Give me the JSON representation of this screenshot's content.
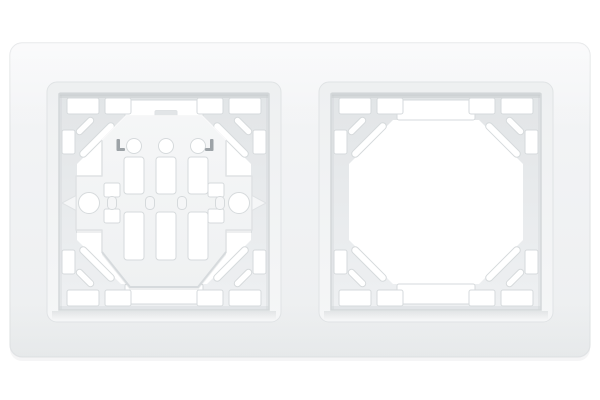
{
  "scene": {
    "type": "product-photo",
    "subject": "White plastic two-gang wall frame for electrical switches and sockets",
    "description": "Horizontal white double frame on a plain white background. The left aperture holds a white octagonal mounting strap with two side fixing screw holes, three round holes and slotted openings; the right aperture is empty, showing edge notches and double diagonal claw slits in each chamfered corner.",
    "background_color": "#ffffff"
  },
  "product": {
    "gang_count": 2,
    "orientation": "horizontal",
    "finish": "matte white plastic",
    "apertures": [
      {
        "position": "left",
        "content": "mounting strap installed",
        "strap": {
          "shape": "octagonal",
          "screw_holes": 2,
          "round_holes": 3,
          "upper_slots": 3,
          "lower_slots": 3,
          "center_bar": true,
          "side_claw_arrows": 2
        }
      },
      {
        "position": "right",
        "content": "empty",
        "collar": {
          "corner_claw_slits_per_corner": 2,
          "top_edge_notches": 4,
          "bottom_edge_notches": 4,
          "side_notches_per_side": 2,
          "center_rail_cuts": 2
        }
      }
    ]
  },
  "parts": {
    "frame": "two-gang frame plate",
    "left_aperture": "left aperture with mounting strap",
    "right_aperture": "empty right aperture",
    "strap": "octagonal mounting strap",
    "screw_hole_left": "left fixing screw hole",
    "screw_hole_right": "right fixing screw hole",
    "claws": "corner claw slits"
  },
  "colors": {
    "bg": "#ffffff",
    "frame1": "#f4f5f7",
    "frame2": "#edeff0",
    "frameStroke": "#e3e5e7",
    "bevel1": "#eef0f1",
    "bevel2": "#f5f6f7",
    "bevelStroke": "#e0e3e5",
    "rimDark": "#c3c7ca",
    "rimMid": "#d4d8da",
    "collar1": "#e2e5e7",
    "collar2": "#eef0f2",
    "collarShadow": "#c8cdd0",
    "hole": "#ffffff",
    "cutStroke": "#d6dadc",
    "strap1": "#f5f6f7",
    "strap2": "#eff1f2",
    "strapStroke": "#dfe2e4",
    "strapShadow": "#d5d9db",
    "markDark": "#8f959a"
  }
}
